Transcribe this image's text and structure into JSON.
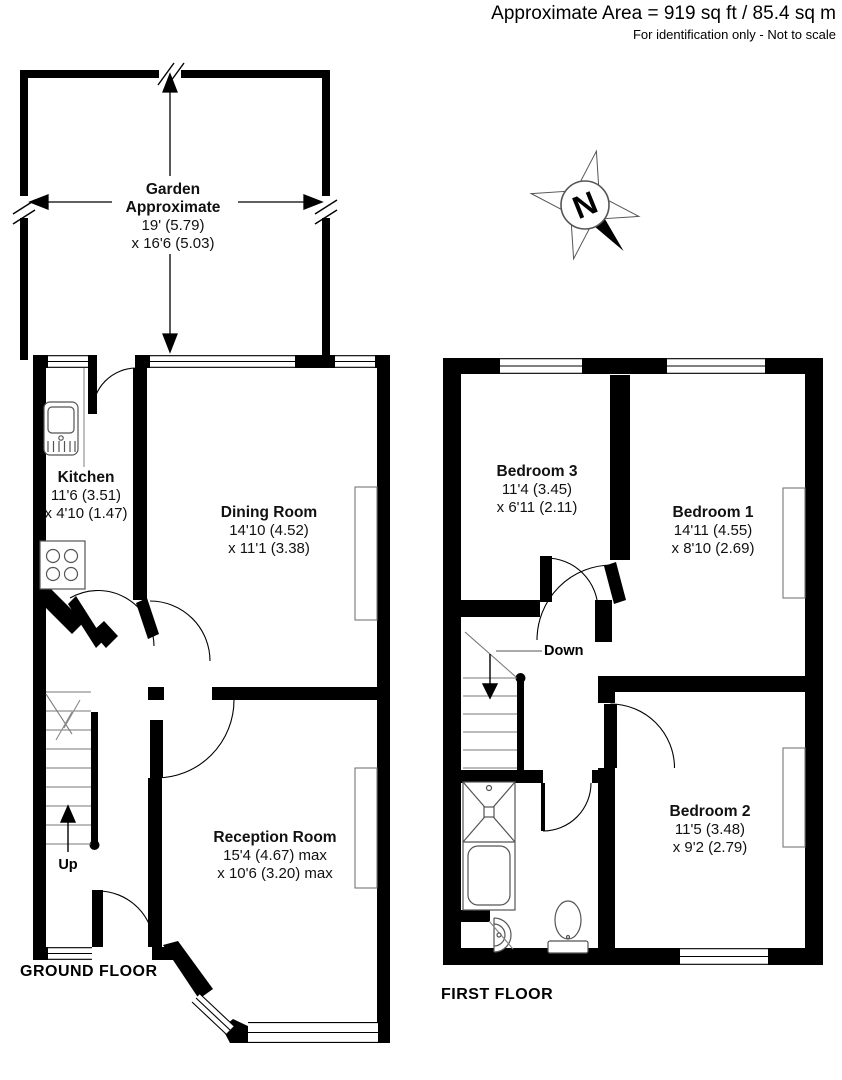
{
  "header": {
    "area_line": "Approximate Area = 919 sq ft / 85.4 sq m",
    "disclaimer": "For identification only - Not to scale"
  },
  "compass": {
    "north": "N"
  },
  "gf": {
    "label": "GROUND FLOOR",
    "up": "Up",
    "garden": {
      "l1": "Garden",
      "l2": "Approximate",
      "d1": "19' (5.79)",
      "d2": "x 16'6 (5.03)"
    },
    "kitchen": {
      "name": "Kitchen",
      "d1": "11'6 (3.51)",
      "d2": "x 4'10 (1.47)"
    },
    "dining": {
      "name": "Dining Room",
      "d1": "14'10 (4.52)",
      "d2": "x 11'1 (3.38)"
    },
    "reception": {
      "name": "Reception Room",
      "d1": "15'4 (4.67) max",
      "d2": "x 10'6 (3.20) max"
    }
  },
  "ff": {
    "label": "FIRST FLOOR",
    "down": "Down",
    "bedroom1": {
      "name": "Bedroom 1",
      "d1": "14'11 (4.55)",
      "d2": "x 8'10 (2.69)"
    },
    "bedroom2": {
      "name": "Bedroom 2",
      "d1": "11'5 (3.48)",
      "d2": "x 9'2 (2.79)"
    },
    "bedroom3": {
      "name": "Bedroom 3",
      "d1": "11'4 (3.45)",
      "d2": "x 6'11 (2.11)"
    }
  },
  "colors": {
    "wall": "#000000",
    "background": "#ffffff"
  }
}
